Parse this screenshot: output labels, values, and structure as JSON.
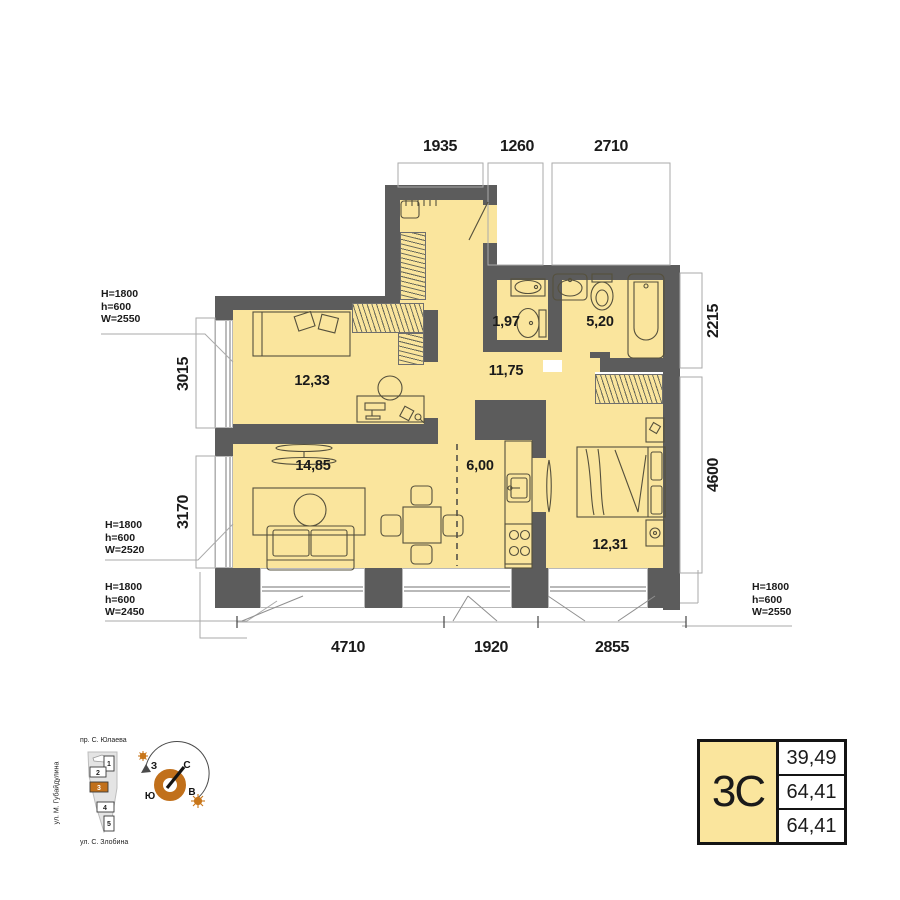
{
  "plan": {
    "dims": {
      "top": [
        "1935",
        "1260",
        "2710"
      ],
      "left": [
        "3015",
        "3170"
      ],
      "right": [
        "2215",
        "4600"
      ],
      "bottom": [
        "4710",
        "1920",
        "2855"
      ]
    },
    "room_areas": {
      "bedroom1": "12,33",
      "wc": "1,97",
      "bathroom": "5,20",
      "hall": "11,75",
      "living": "14,85",
      "kitchen": "6,00",
      "bedroom2": "12,31"
    },
    "window_specs": {
      "left_top": [
        "H=1800",
        "h=600",
        "W=2550"
      ],
      "left_mid": [
        "H=1800",
        "h=600",
        "W=2520"
      ],
      "left_bottom": [
        "H=1800",
        "h=600",
        "W=2450"
      ],
      "right_bottom": [
        "H=1800",
        "h=600",
        "W=2550"
      ]
    }
  },
  "site": {
    "street_top": "пр. С. Юлаева",
    "street_left": "ул. М. Губайдулина",
    "street_bottom": "ул. С. Злобина",
    "buildings": [
      "1",
      "2",
      "3",
      "4",
      "5"
    ],
    "highlighted_building": "3"
  },
  "compass": {
    "north": "С",
    "east": "В",
    "south": "Ю",
    "west": "З"
  },
  "stats": {
    "plan_type": "3С",
    "values": [
      "39,49",
      "64,41",
      "64,41"
    ]
  },
  "colors": {
    "room_fill": "#fae59d",
    "wall": "#5c5c5c",
    "accent_orange": "#c1701b"
  }
}
